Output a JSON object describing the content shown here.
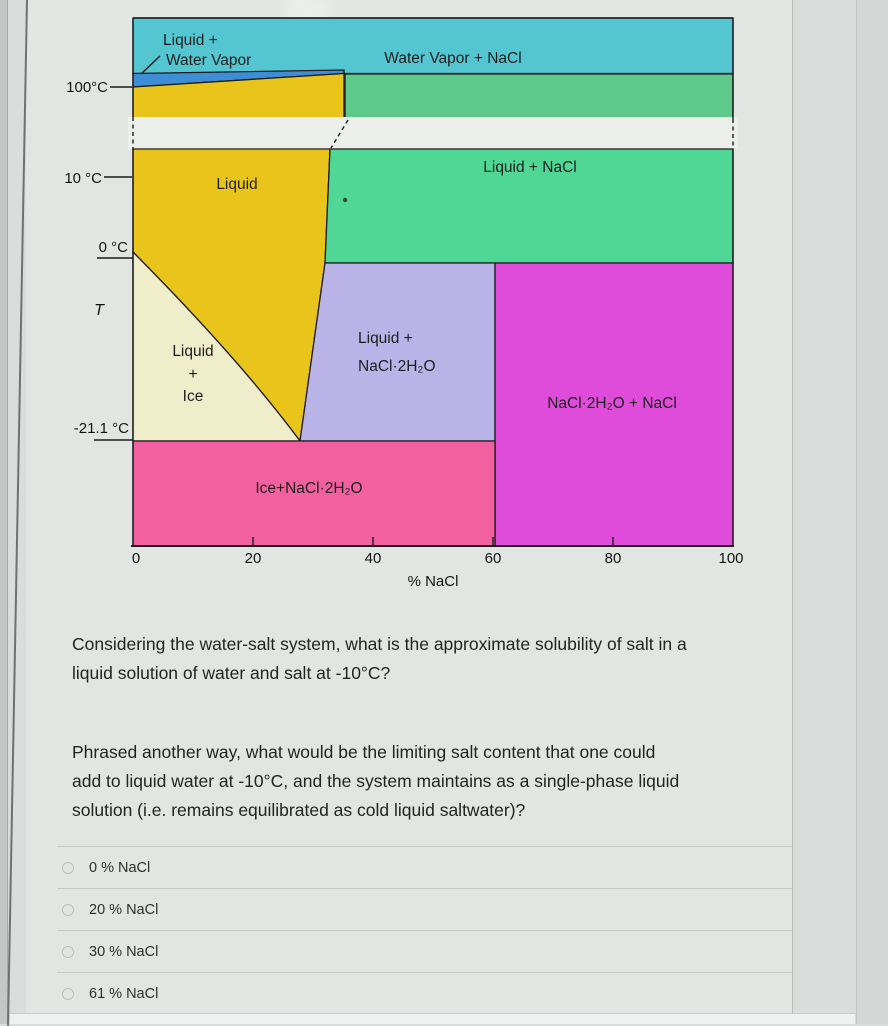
{
  "chart": {
    "break_color": "#edefeb",
    "x_axis": {
      "label": "% NaCl",
      "ticks": [
        "0",
        "20",
        "40",
        "60",
        "80",
        "100"
      ]
    },
    "y_axis": {
      "symbol": "T",
      "ticks": [
        "100°C",
        "10 °C",
        "0 °C",
        "-21.1 °C"
      ]
    },
    "regions": {
      "water_vapor_nacl": {
        "label": "Water Vapor + NaCl",
        "color": "#53c6d1"
      },
      "liquid_water_vapor": {
        "lines": [
          "Liquid +",
          "Water Vapor"
        ],
        "color": "#3e8ed6"
      },
      "liquid": {
        "label": "Liquid",
        "color": "#e9c51c"
      },
      "liquid_nacl": {
        "label": "Liquid + NaCl",
        "color_upper": "#5fc98c",
        "color_lower": "#50d795"
      },
      "liquid_ice": {
        "lines": [
          "Liquid",
          "+",
          "Ice"
        ],
        "color": "#f0eeca"
      },
      "liquid_nacl_2h2o": {
        "lines": [
          "Liquid +",
          "NaCl·2H₂O"
        ],
        "color": "#b9b3e8"
      },
      "nacl_2h2o_nacl": {
        "label": "NaCl·2H₂O + NaCl",
        "color": "#e04cda"
      },
      "ice_nacl_2h2o": {
        "label": "Ice+NaCl·2H₂O",
        "color": "#f2609f"
      }
    }
  },
  "question": {
    "paragraph1_lines": [
      "Considering the water-salt system, what is the approximate solubility of salt in a",
      "liquid solution of water and salt at -10°C?"
    ],
    "paragraph2_lines": [
      "Phrased another way, what would be the limiting salt content that one could",
      "add to liquid water at -10°C, and the system maintains as a single-phase liquid",
      "solution (i.e. remains equilibrated as cold liquid saltwater)?"
    ]
  },
  "options": [
    {
      "label": "0 % NaCl"
    },
    {
      "label": "20 % NaCl"
    },
    {
      "label": "30 % NaCl"
    },
    {
      "label": "61 % NaCl"
    }
  ]
}
